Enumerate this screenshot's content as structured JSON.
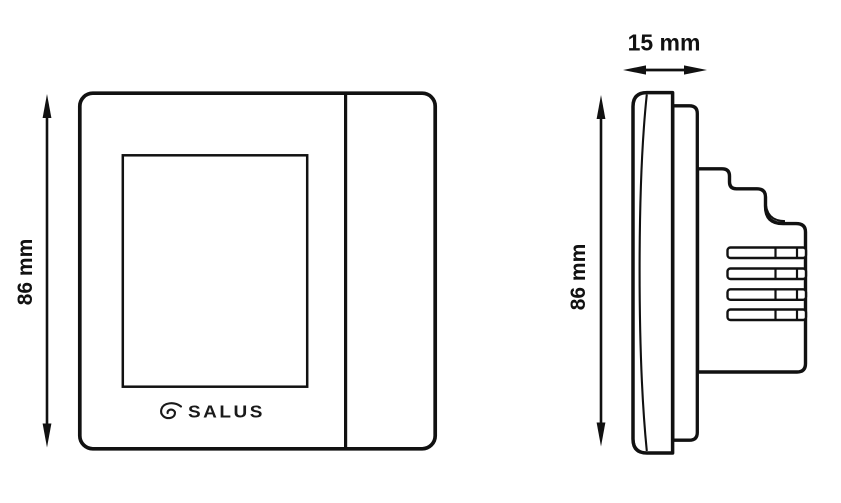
{
  "colors": {
    "line": "#111111",
    "background": "#ffffff"
  },
  "views": {
    "front": {
      "height_dimension": "86 mm",
      "logo_text": "SALUS"
    },
    "side": {
      "height_dimension": "86 mm",
      "depth_dimension": "15 mm"
    }
  },
  "dimensions": {
    "height_mm": 86,
    "depth_mm": 15
  }
}
